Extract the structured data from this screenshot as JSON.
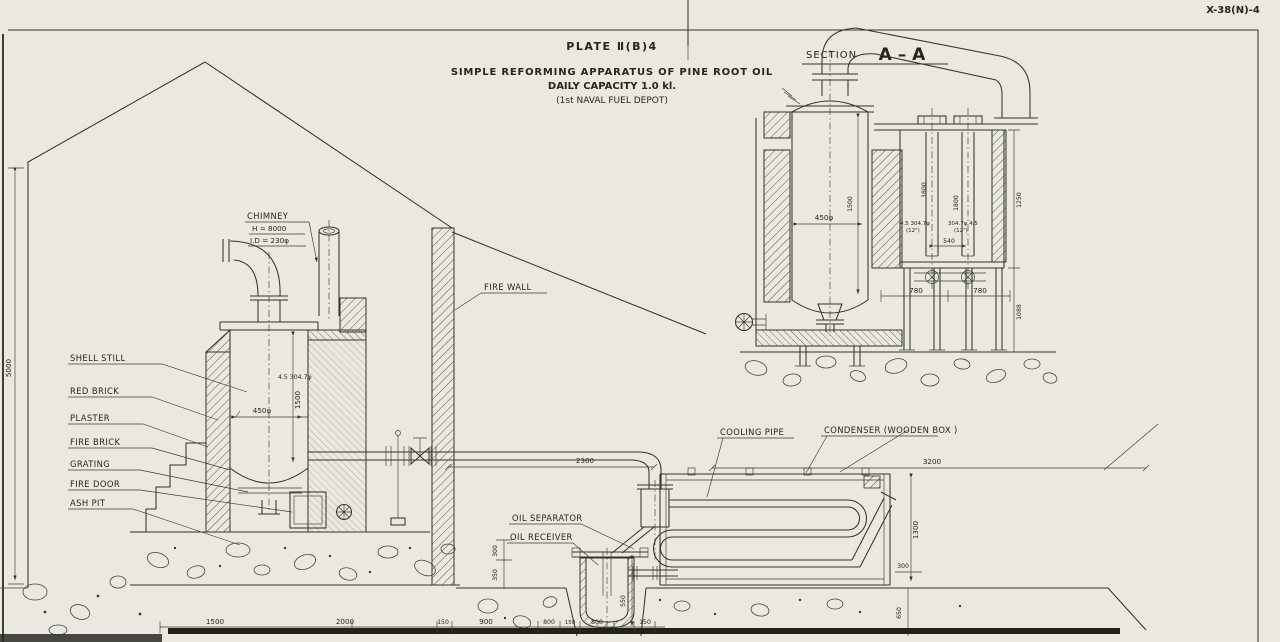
{
  "doc": {
    "number": "X-38(N)-4",
    "plate": "PLATE Ⅱ(B)4",
    "title": "SIMPLE REFORMING APPARATUS OF PINE ROOT OIL",
    "capacity": "DAILY CAPACITY 1.0 kl.",
    "depot": "(1st NAVAL FUEL DEPOT)",
    "section_title": "SECTION",
    "section_name": "A – A"
  },
  "labels": {
    "chimney": "CHIMNEY",
    "chimney_h": "H = 8000",
    "chimney_id": "I.D = 230φ",
    "fire_wall": "FIRE WALL",
    "shell_still": "SHELL STILL",
    "red_brick": "RED BRICK",
    "plaster": "PLASTER",
    "fire_brick": "FIRE BRICK",
    "grating": "GRATING",
    "fire_door": "FIRE DOOR",
    "ash_pit": "ASH PIT",
    "cooling_pipe": "COOLING PIPE",
    "condenser": "CONDENSER (WOODEN BOX )",
    "oil_separator": "OIL SEPARATOR",
    "oil_receiver": "OIL RECEIVER"
  },
  "dims": {
    "building_height": "5000",
    "still_pipe": "4.5 304.7φ",
    "still_dia": "450φ",
    "still_height": "1500",
    "vapor_run": "2300",
    "condenser_len": "3200",
    "cond_height": "1300",
    "cond_base": "300",
    "receiver_depth": "550",
    "pit_350": "350",
    "pit_300": "300",
    "right_650": "650",
    "bottom": [
      "1500",
      "2000",
      "150",
      "900",
      "800",
      "150",
      "800",
      "150"
    ]
  },
  "section_dims": {
    "still_dia": "450φ",
    "still_height": "1500",
    "tube_a": "1800",
    "tube_b": "1800",
    "tube_pitch": "540",
    "box_height": "1250",
    "leg_a": "780",
    "leg_b": "780",
    "leg_height": "1088",
    "pipe_a": "4.5 304.7φ",
    "pipe_a_in": "(12\")",
    "pipe_b": "304.7φ 4.5",
    "pipe_b_in": "(12\")"
  }
}
